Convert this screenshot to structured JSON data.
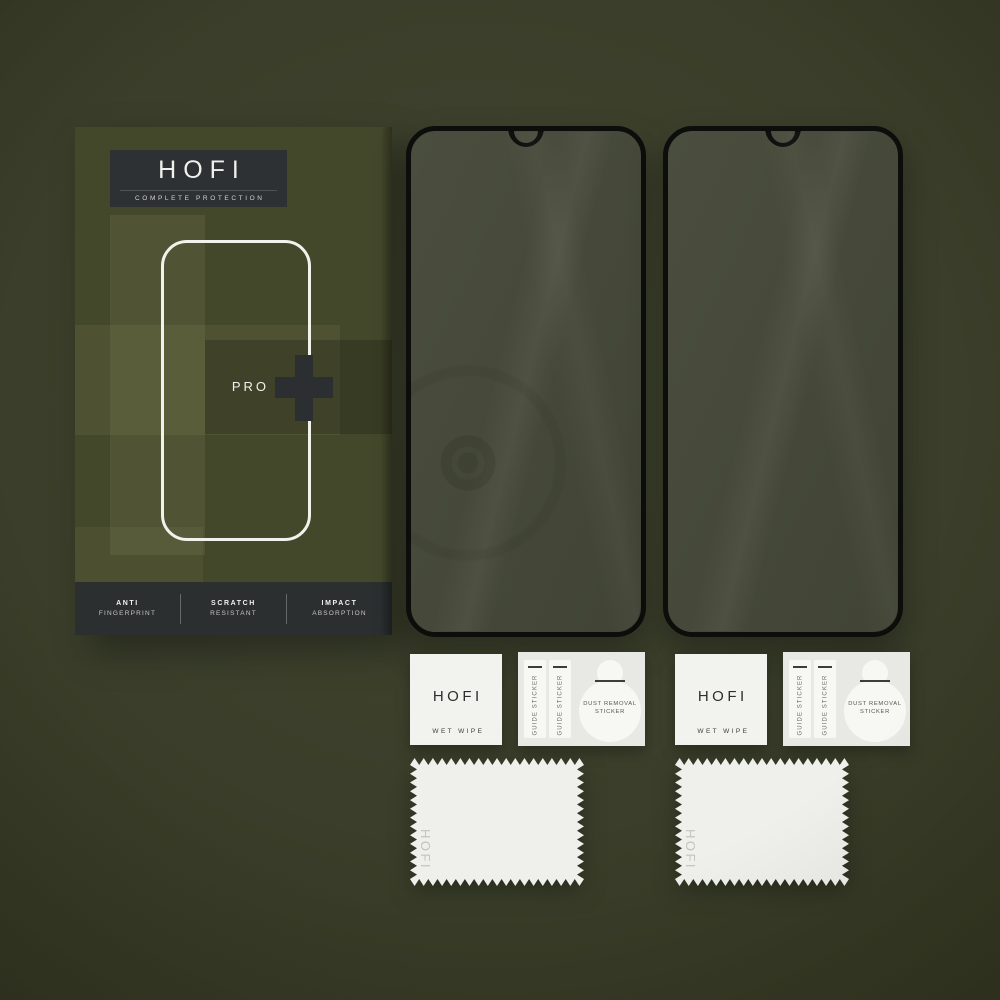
{
  "box": {
    "brand": "HOFI",
    "tagline": "COMPLETE PROTECTION",
    "model": "PRO",
    "features": [
      {
        "line1": "ANTI",
        "line2": "FINGERPRINT"
      },
      {
        "line1": "SCRATCH",
        "line2": "RESISTANT"
      },
      {
        "line1": "IMPACT",
        "line2": "ABSORPTION"
      }
    ]
  },
  "accessories": {
    "wet_wipe_brand": "HOFI",
    "wet_wipe_label": "WET WIPE",
    "guide_sticker_label": "GUIDE STICKER",
    "dust_removal_line1": "DUST REMOVAL",
    "dust_removal_line2": "STICKER",
    "cloth_brand": "HOFI"
  },
  "colors": {
    "background_olive": "#3a3e2a",
    "box_olive": "#44482b",
    "charcoal_dark": "#2c3032",
    "glass_border_black": "#0d0d0b",
    "glass_tint_olive": "#474a3a",
    "paper_white": "#f1f1ed"
  }
}
